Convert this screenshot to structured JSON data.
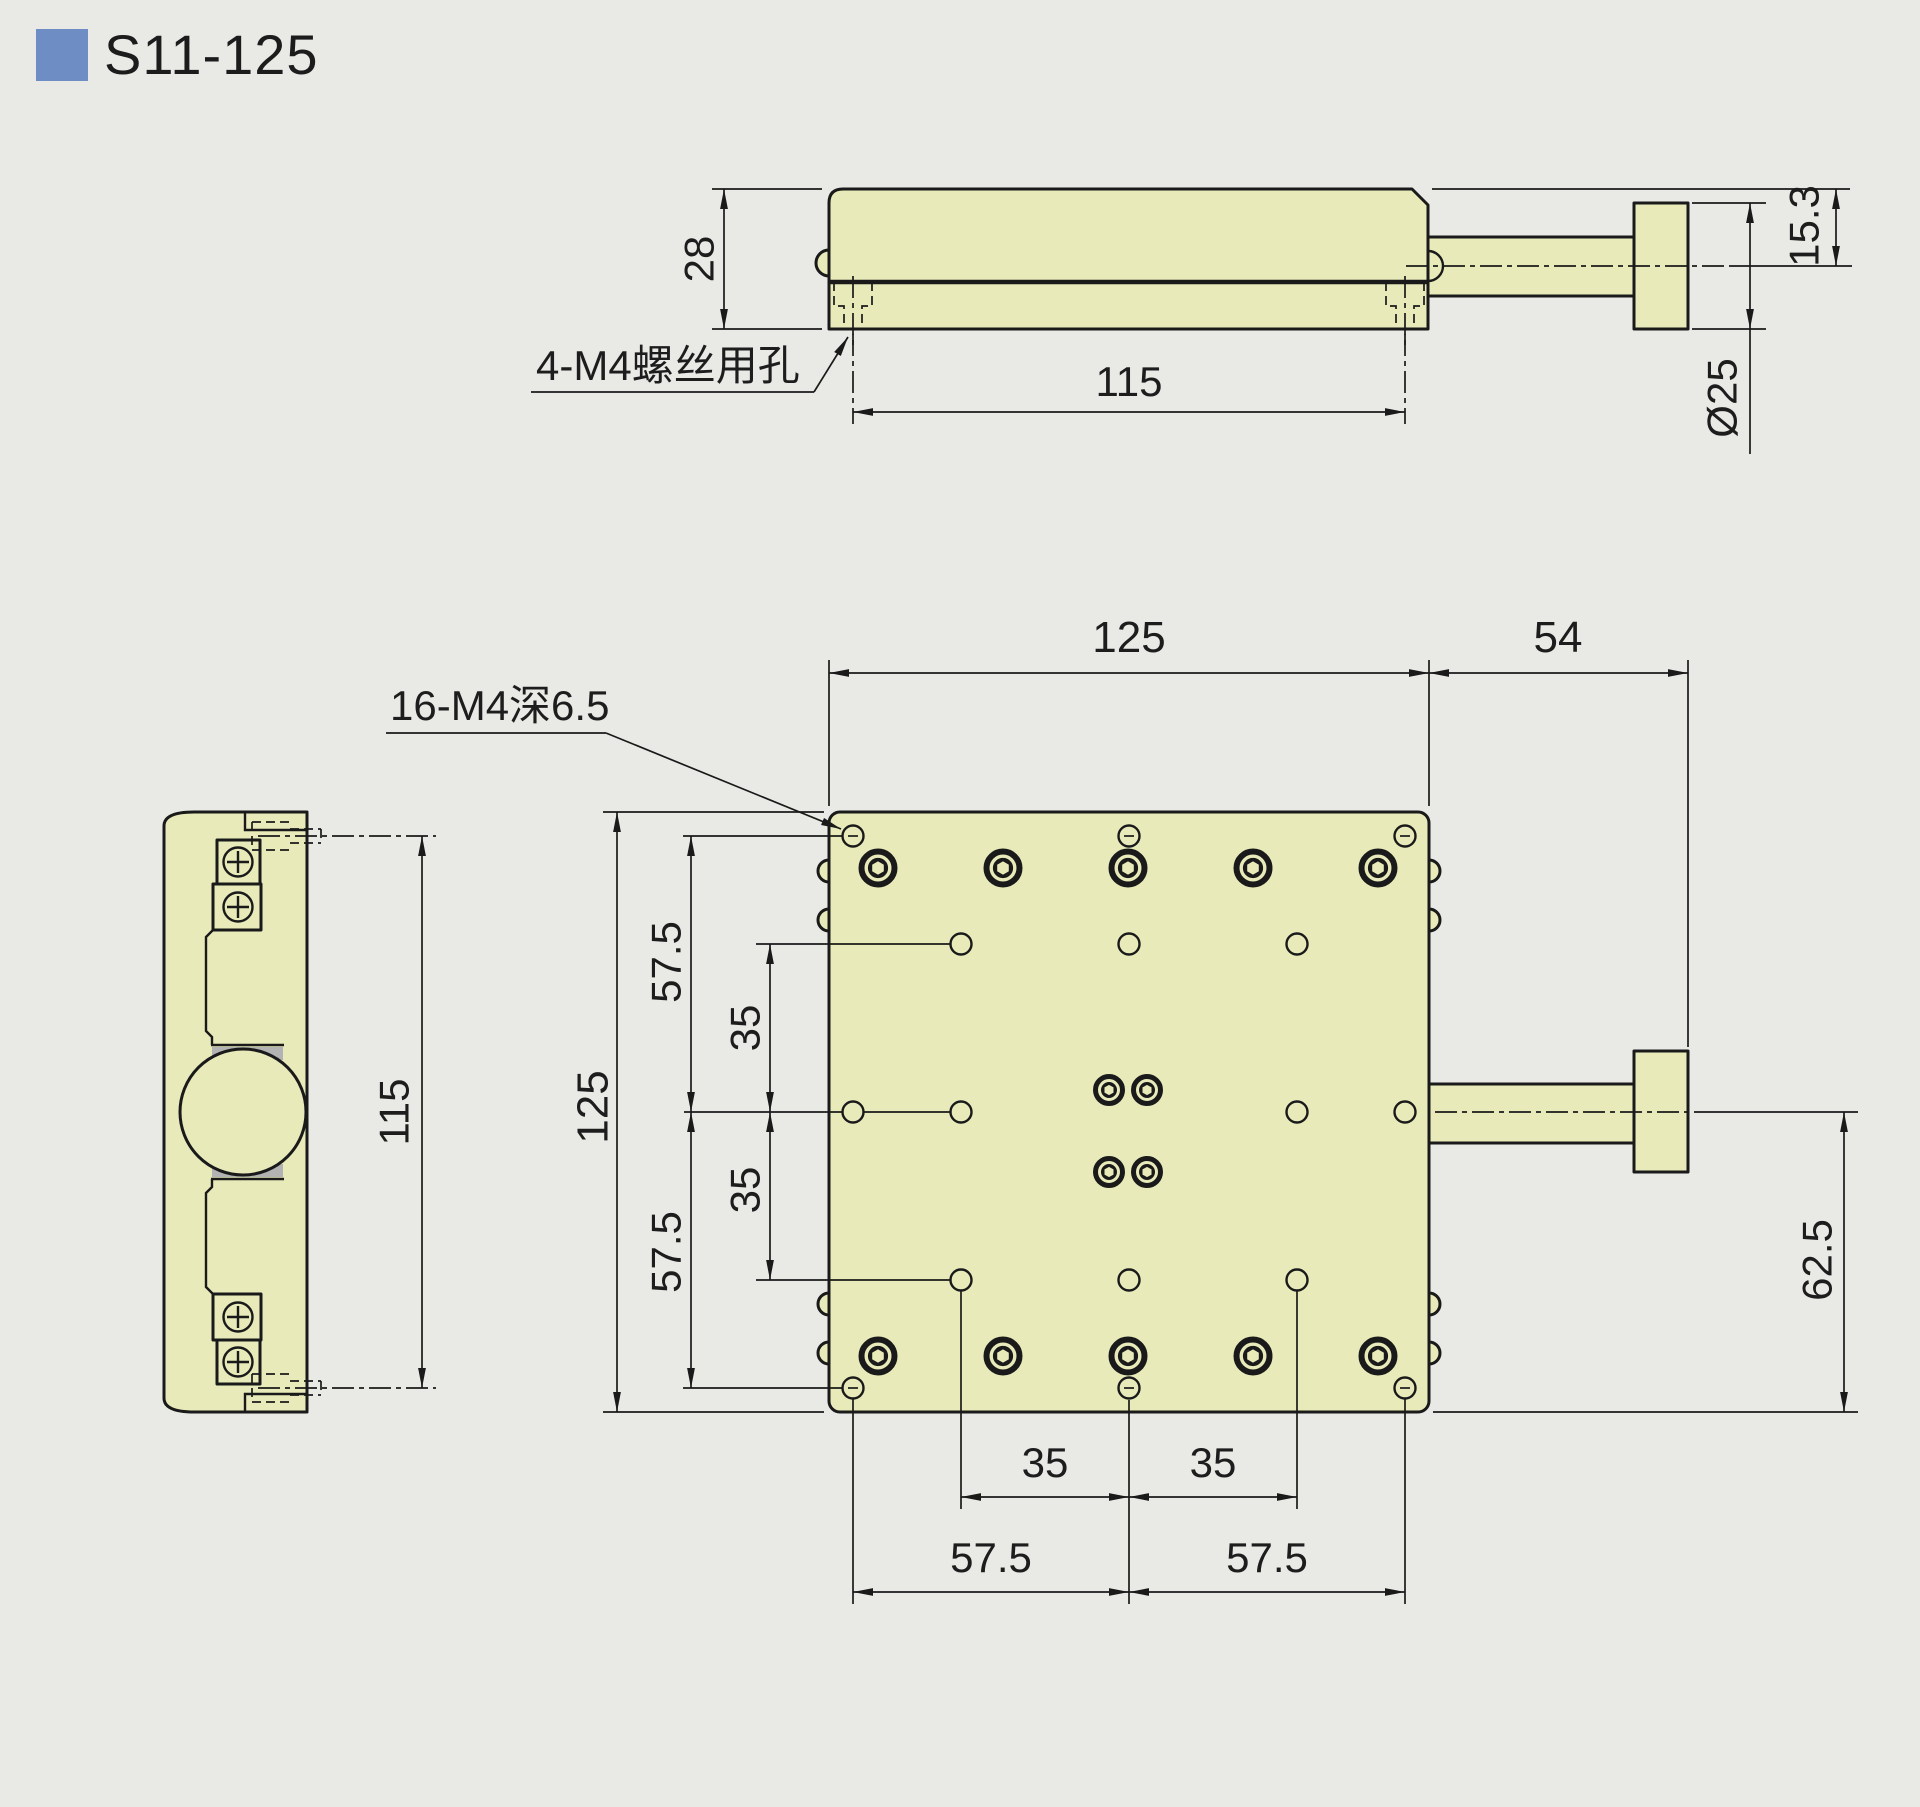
{
  "title": {
    "model": "S11-125"
  },
  "side_view": {
    "body_height": "28",
    "hole_span": "115",
    "axis_offset": "15.3",
    "knob_diameter": "Ø25",
    "holes_label": "4-M4螺丝用孔"
  },
  "end_view": {
    "hole_span": "115"
  },
  "plan_view": {
    "plate_width": "125",
    "knob_extent": "54",
    "plate_height": "125",
    "row_upper": "57.5",
    "row_upper_inner": "35",
    "row_lower_inner": "35",
    "row_lower": "57.5",
    "col_inner_left": "35",
    "col_inner_right": "35",
    "col_outer_left": "57.5",
    "col_outer_right": "57.5",
    "axis_to_edge": "62.5",
    "holes_label": "16-M4深6.5"
  },
  "colors": {
    "part_fill": "#e8eaba",
    "line": "#1a1a1a",
    "background": "#e9e9e6",
    "accent_blue": "#6e8dc5",
    "bearing_gray": "#b3b3b3"
  }
}
